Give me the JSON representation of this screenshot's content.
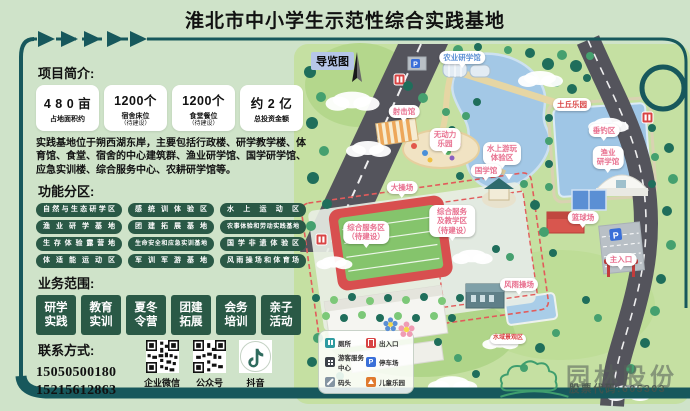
{
  "colors": {
    "frame_teal": "#17585c",
    "badge_green": "#2a5946",
    "track_red": "#d84f4f",
    "water_blue": "#a3c8e6",
    "bubble_pink": "#e8708f"
  },
  "title": "淮北市中小学生示范性综合实践基地",
  "left_panel": {
    "intro_heading": "项目简介:",
    "stats": [
      {
        "value": "4 8 0 亩",
        "label": "占地面积约",
        "sub": ""
      },
      {
        "value": "1200个",
        "label": "宿舍床位",
        "sub": "（待建设）"
      },
      {
        "value": "1200个",
        "label": "食堂餐位",
        "sub": "（待建设）"
      },
      {
        "value": "约 2 亿",
        "label": "总投资金额",
        "sub": ""
      }
    ],
    "description": "实践基地位于朔西湖东岸，主要包括行政楼、研学教学楼、体育馆、食堂、宿舍的中心建筑群、渔业研学馆、国学研学馆、应急实训楼、综合服务中心、农耕研学馆等。",
    "zones_heading": "功能分区:",
    "zones": [
      "自然与生态研学区",
      "感统训体验区",
      "水上运动区",
      "渔业研学基地",
      "团建拓展基地",
      "农事体验和劳动实践基地",
      "生存体验露营地",
      "生命安全和应急实训基地",
      "国学非遗体验区",
      "体适能运动区",
      "军训军游基地",
      "风雨操场和体育场"
    ],
    "business_heading": "业务范围:",
    "business": [
      {
        "l1": "研学",
        "l2": "实践"
      },
      {
        "l1": "教育",
        "l2": "实训"
      },
      {
        "l1": "夏冬",
        "l2": "令营"
      },
      {
        "l1": "团建",
        "l2": "拓展"
      },
      {
        "l1": "会务",
        "l2": "培训"
      },
      {
        "l1": "亲子",
        "l2": "活动"
      }
    ],
    "contact_heading": "联系方式:",
    "phones": [
      "15050500180",
      "15215612863"
    ],
    "qr": [
      {
        "label": "企业微信"
      },
      {
        "label": "公众号"
      },
      {
        "label": "抖音"
      }
    ]
  },
  "map": {
    "tag": "导览图",
    "labels": {
      "nongye": "农业研学馆",
      "sheji": "射击馆",
      "wudongli": "无动力\n乐园",
      "tuqiu": "土丘乐园",
      "chuidiao": "垂钓区",
      "yuye": "渔业\n研学馆",
      "shuishang": "水上游玩\n体验区",
      "guoxue": "国学馆",
      "dacaochang": "大操场",
      "fuwuqu": "综合服务区\n（待建设）",
      "jiaoxue": "综合服务\n及教学区\n（待建设）",
      "lanqiu": "篮球场",
      "rukou": "主入口",
      "fengyu": "风雨操场",
      "shuiyu": "水域景观区"
    },
    "icons": {
      "parking_letter": "P"
    },
    "legend": [
      {
        "label": "厕所"
      },
      {
        "label": "出入口"
      },
      {
        "label": "游客服务中心"
      },
      {
        "label": "停车场"
      },
      {
        "label": "码头"
      },
      {
        "label": "儿童乐园"
      }
    ]
  },
  "footer": {
    "brand": "园林股份",
    "stock_code": "股票代码:605303"
  }
}
